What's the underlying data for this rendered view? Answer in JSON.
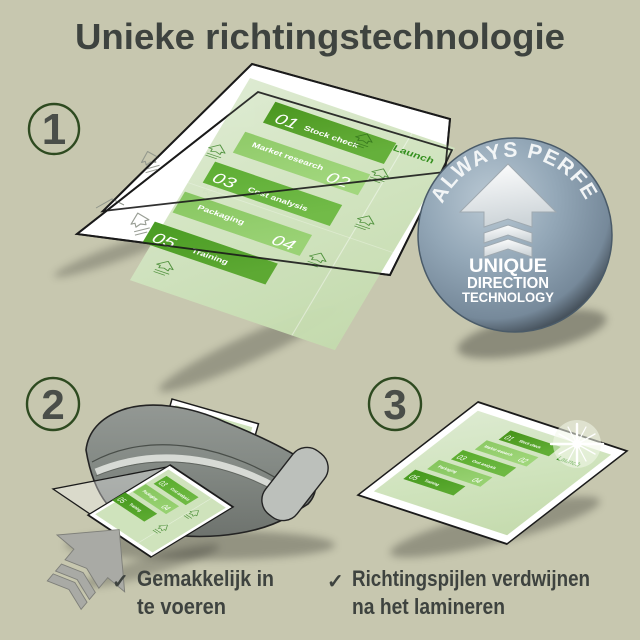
{
  "title": "Unieke richtingstechnologie",
  "steps": {
    "s1": "1",
    "s2": "2",
    "s3": "3"
  },
  "badge": {
    "curved_text": "ALWAYS PERFECT!",
    "line1": "UNIQUE",
    "line2": "DIRECTION",
    "line3": "TECHNOLOGY"
  },
  "doc": {
    "launch_label": "Launch",
    "items": [
      {
        "num": "01",
        "label": "Stock check"
      },
      {
        "num": "02",
        "label": "Market research"
      },
      {
        "num": "03",
        "label": "Cost analysis"
      },
      {
        "num": "04",
        "label": "Packaging"
      },
      {
        "num": "05",
        "label": "Training"
      }
    ]
  },
  "captions": {
    "check": "✓",
    "left1": "Gemakkelijk in",
    "left2": "te voeren",
    "right1": "Richtingspijlen verdwijnen",
    "right2": "na het lamineren"
  },
  "colors": {
    "background": "#c7c7af",
    "ink": "#3e433f",
    "accent_green": "#4f9e2a",
    "pale_green": "#cfe3bc",
    "badge_blue": "#8ea2b2",
    "ring_green": "#2e4a20"
  }
}
